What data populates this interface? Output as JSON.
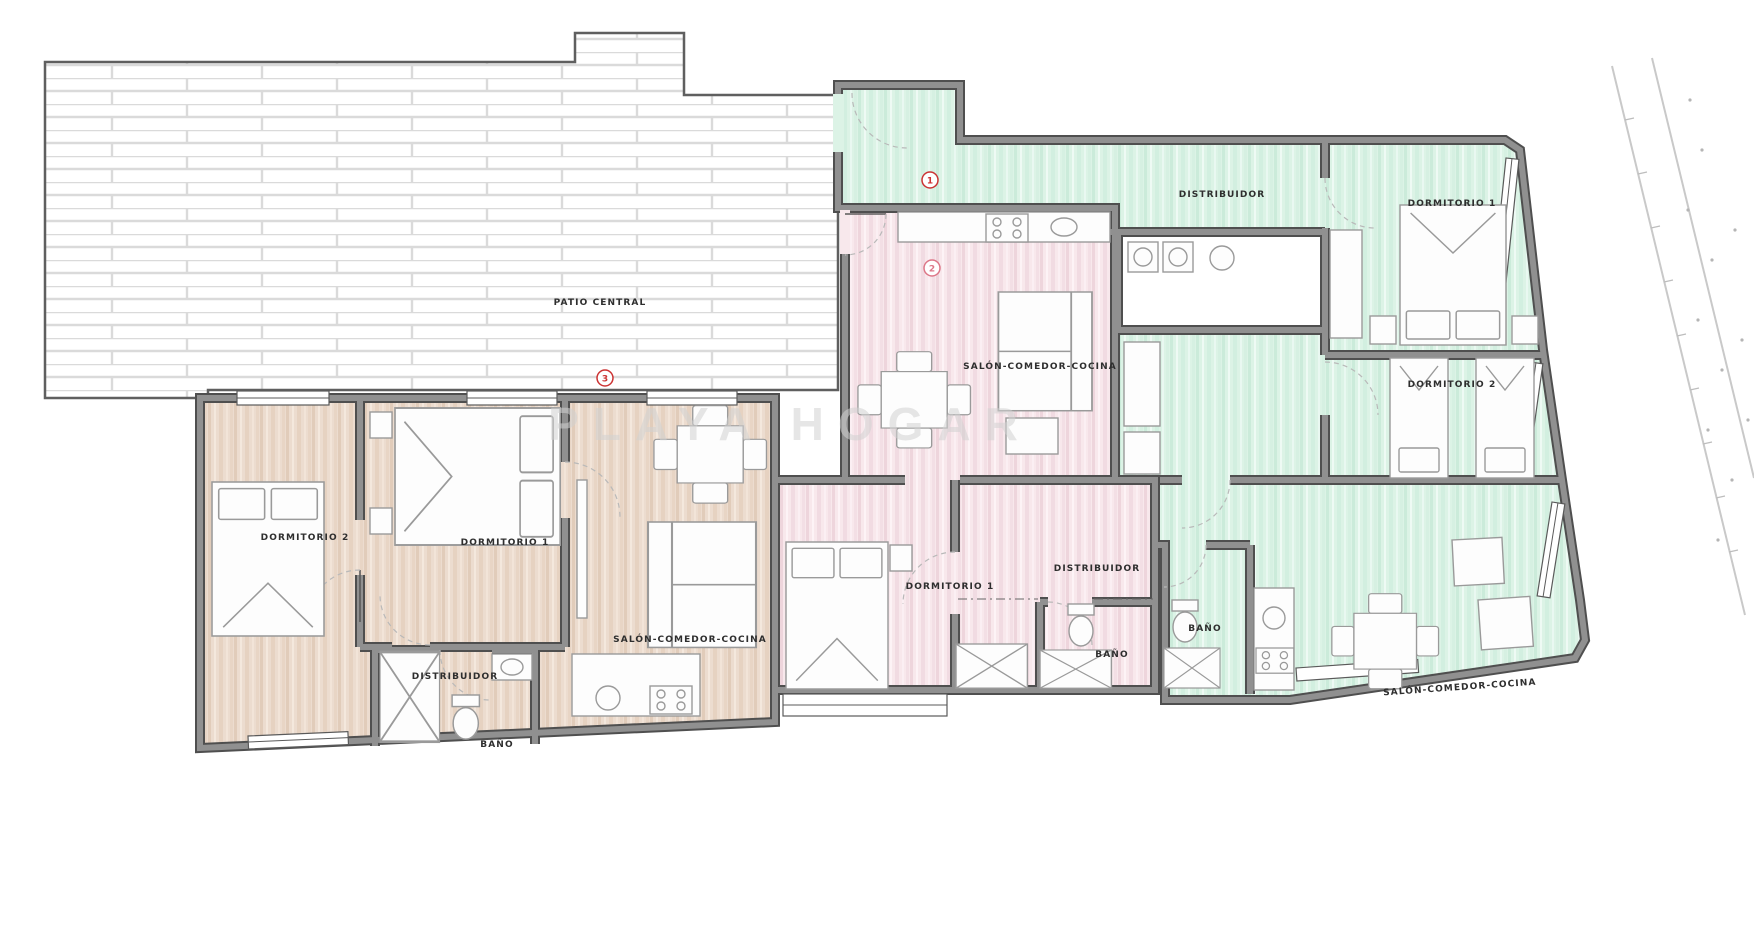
{
  "watermark": {
    "text": "PLAYA HOGAR"
  },
  "patio": {
    "label": "PATIO CENTRAL"
  },
  "markers": [
    {
      "value": "1",
      "color": "#cc3333"
    },
    {
      "value": "2",
      "color": "#dd7788"
    },
    {
      "value": "3",
      "color": "#cc3333"
    }
  ],
  "apartments": [
    {
      "id": "vivienda-izquierda",
      "floor": "beige",
      "floor_color": "#ecdccf",
      "rooms": [
        {
          "label": "DORMITORIO 2"
        },
        {
          "label": "DORMITORIO 1"
        },
        {
          "label": "DISTRIBUIDOR"
        },
        {
          "label": "SALÓN-COMEDOR-COCINA"
        },
        {
          "label": "BAÑO"
        }
      ]
    },
    {
      "id": "vivienda-central",
      "floor": "pink",
      "floor_color": "#f8e8ec",
      "rooms": [
        {
          "label": "SALÓN-COMEDOR-COCINA"
        },
        {
          "label": "DORMITORIO 1"
        },
        {
          "label": "DISTRIBUIDOR"
        },
        {
          "label": "BAÑO"
        }
      ]
    },
    {
      "id": "vivienda-derecha",
      "floor": "green",
      "floor_color": "#dcf3e6",
      "rooms": [
        {
          "label": "DISTRIBUIDOR"
        },
        {
          "label": "DORMITORIO 1"
        },
        {
          "label": "DORMITORIO 2"
        },
        {
          "label": "BAÑO"
        },
        {
          "label": "SALÓN-COMEDOR-COCINA"
        }
      ]
    }
  ],
  "colors": {
    "wall": "#909090",
    "wall_edge": "#4f4f4f",
    "patio_brick_line": "#dadada",
    "label_text": "#2e2e2e",
    "watermark": "#d2d2d2",
    "road_line": "#c9c9c9"
  }
}
